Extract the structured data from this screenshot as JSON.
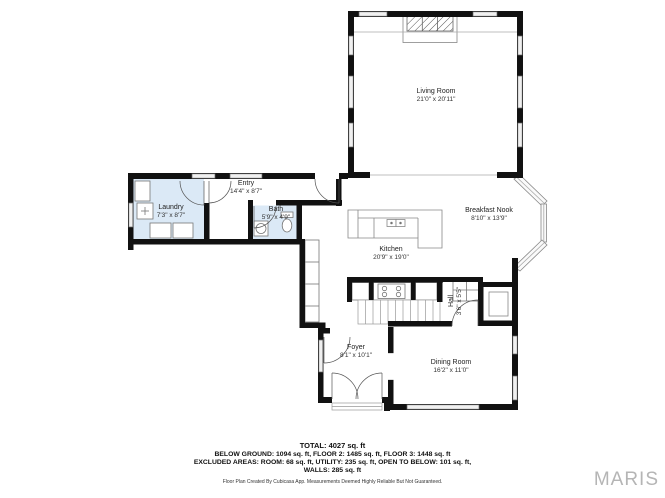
{
  "plan": {
    "rooms": [
      {
        "id": "living-room",
        "name": "Living Room",
        "dims": "21'0\" x 20'11\""
      },
      {
        "id": "entry",
        "name": "Entry",
        "dims": "14'4\" x 8'7\""
      },
      {
        "id": "laundry",
        "name": "Laundry",
        "dims": "7'3\" x 8'7\""
      },
      {
        "id": "bath",
        "name": "Bath",
        "dims": "5'9\" x 4'9\""
      },
      {
        "id": "kitchen",
        "name": "Kitchen",
        "dims": "20'9\" x 19'0\""
      },
      {
        "id": "breakfast-nook",
        "name": "Breakfast Nook",
        "dims": "8'10\" x 13'9\""
      },
      {
        "id": "hall",
        "name": "Hall",
        "dims": "3'6\" x 5'5\""
      },
      {
        "id": "foyer",
        "name": "Foyer",
        "dims": "8'1\" x 10'1\""
      },
      {
        "id": "dining-room",
        "name": "Dining Room",
        "dims": "16'2\" x 11'0\""
      }
    ],
    "fixtures": [
      "fireplace",
      "washer",
      "laundry-counter",
      "bathroom-sink",
      "toilet",
      "pantry-cabinets",
      "kitchen-island",
      "island-sink",
      "stove",
      "refrigerator",
      "staircase",
      "closet",
      "bay-window",
      "french-doors",
      "stoop"
    ]
  },
  "summary": {
    "total": "TOTAL: 4027 sq. ft",
    "line2": "BELOW GROUND: 1094 sq. ft, FLOOR 2: 1485 sq. ft, FLOOR 3: 1448 sq. ft",
    "line3": "EXCLUDED AREAS: ROOM: 68 sq. ft, UTILITY: 235 sq. ft, OPEN TO BELOW: 101 sq. ft,",
    "line4": "WALLS: 285 sq. ft"
  },
  "disclaimer": "Floor Plan Created By Cubicasa App. Measurements Deemed Highly Reliable But Not Guaranteed.",
  "branding": {
    "logo": "MARIS"
  },
  "colors": {
    "wall": "#111111",
    "wet_room_fill": "#dbe9f6",
    "window_fill": "#f0f0f0",
    "logo_gray": "#b5b5b5"
  }
}
